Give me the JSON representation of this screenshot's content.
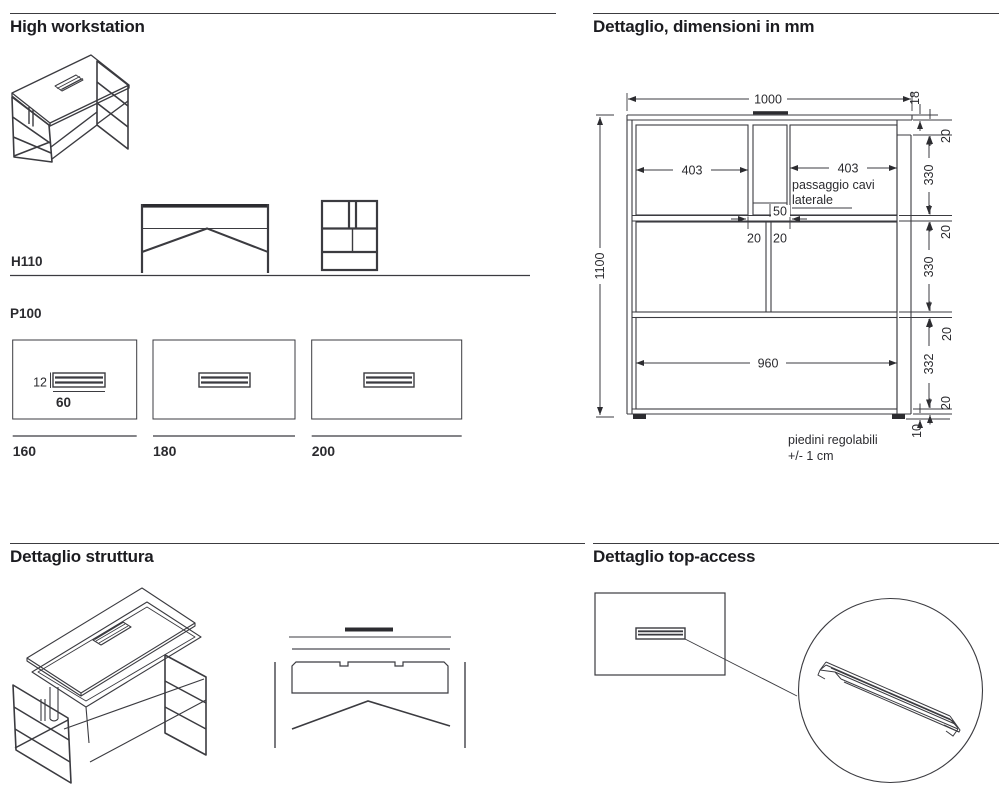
{
  "sections": {
    "hw": {
      "title": "High workstation",
      "h110": "H110",
      "p100": "P100",
      "slot_h": "12",
      "slot_w": "60",
      "w1": "160",
      "w2": "180",
      "w3": "200"
    },
    "dim": {
      "title": "Dettaglio, dimensioni in mm",
      "total_w": "1000",
      "total_h": "1100",
      "top_thick": "18",
      "gap_a": "20",
      "row1": "330",
      "gap_b": "20",
      "row2": "330",
      "gap_c": "20",
      "row3": "332",
      "gap_d": "20",
      "feet_h": "10",
      "shelf_l": "403",
      "shelf_r": "403",
      "cable_note_1": "passaggio cavi",
      "cable_note_2": "laterale",
      "slot_w": "50",
      "wall_l": "20",
      "wall_r": "20",
      "bottom_w": "960",
      "feet_note_1": "piedini regolabili",
      "feet_note_2": "+/- 1 cm"
    },
    "struct": {
      "title": "Dettaglio struttura"
    },
    "ta": {
      "title": "Dettaglio top-access"
    }
  }
}
